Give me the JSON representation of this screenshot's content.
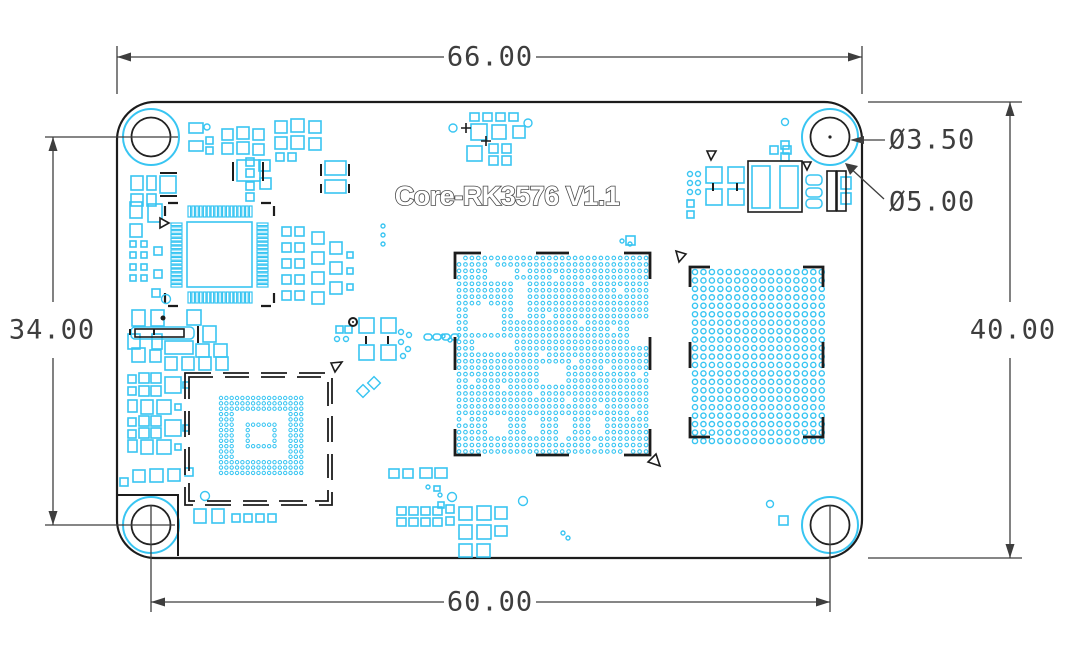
{
  "title": {
    "board_name": "Core-RK3576 V1.1"
  },
  "dimensions": {
    "board_width_label": "66.00",
    "hole_span_label": "60.00",
    "hole_vertical_span_label": "34.00",
    "board_height_label": "40.00",
    "hole_drill_label": "Ø3.50",
    "hole_pad_label": "Ø5.00"
  },
  "colors": {
    "copper": "#38c5f2",
    "outline": "#1c1c1c",
    "dim": "#3e3e3e",
    "title_stroke": "#4a4a4a"
  },
  "board": {
    "x": 117,
    "y": 102,
    "w": 745,
    "h": 456,
    "corner_radius": 38
  },
  "holes": {
    "centers": [
      [
        151,
        137
      ],
      [
        830,
        137
      ],
      [
        151,
        525
      ],
      [
        830,
        525
      ]
    ],
    "pad_r": 28,
    "drill_r": 19.5,
    "center_dot_index": 1
  },
  "footprints": {
    "qfp": {
      "body": [
        187,
        222,
        65,
        65
      ],
      "pins_per_side": 17,
      "pitch": 3.84,
      "pin_w": 2.6,
      "pin_len": 11,
      "pin_gap": 5
    },
    "bga_center": {
      "x0": 459,
      "y0": 258,
      "cols": 30,
      "rows": 31,
      "pitch": 6.45,
      "r": 1.8,
      "voids": [
        [
          5,
          2,
          4,
          2
        ],
        [
          2,
          8,
          5,
          4
        ],
        [
          3,
          13,
          6,
          2
        ],
        [
          9,
          4,
          2,
          6
        ],
        [
          5,
          25,
          3,
          3
        ],
        [
          11,
          25,
          2,
          3
        ],
        [
          16,
          25,
          2,
          3
        ],
        [
          21,
          25,
          2,
          3
        ],
        [
          27,
          10,
          3,
          4
        ],
        [
          13,
          17,
          4,
          3
        ]
      ]
    },
    "bga_right": {
      "x0": 695,
      "y0": 272,
      "cols": 16,
      "rows": 21,
      "pitch": 8.45,
      "r": 2.6
    },
    "bga_module": {
      "x0": 221,
      "y0": 398,
      "cols": 16,
      "rows": 15,
      "pitch": 5.35,
      "r": 1.7
    }
  },
  "pads": {
    "rects": [
      [
        189,
        123,
        14,
        10
      ],
      [
        189,
        141,
        14,
        10
      ],
      [
        206,
        137,
        7,
        7
      ],
      [
        206,
        147,
        7,
        7
      ],
      [
        222,
        129,
        11,
        11
      ],
      [
        237,
        127,
        12,
        12
      ],
      [
        253,
        129,
        11,
        11
      ],
      [
        222,
        143,
        11,
        11
      ],
      [
        237,
        142,
        12,
        12
      ],
      [
        253,
        144,
        11,
        11
      ],
      [
        275,
        121,
        12,
        12
      ],
      [
        291,
        119,
        13,
        13
      ],
      [
        309,
        121,
        12,
        12
      ],
      [
        275,
        137,
        12,
        12
      ],
      [
        291,
        136,
        13,
        13
      ],
      [
        309,
        138,
        12,
        12
      ],
      [
        246,
        158,
        8,
        8
      ],
      [
        246,
        169,
        8,
        8
      ],
      [
        259,
        160,
        11,
        11
      ],
      [
        276,
        153,
        8,
        8
      ],
      [
        288,
        153,
        8,
        8
      ],
      [
        237,
        160,
        23,
        21
      ],
      [
        325,
        161,
        21,
        14
      ],
      [
        325,
        180,
        21,
        13
      ],
      [
        246,
        182,
        8,
        8
      ],
      [
        246,
        193,
        8,
        8
      ],
      [
        260,
        178,
        11,
        11
      ],
      [
        131,
        176,
        12,
        14
      ],
      [
        147,
        176,
        9,
        14
      ],
      [
        160,
        176,
        16,
        17
      ],
      [
        131,
        194,
        12,
        12
      ],
      [
        147,
        194,
        9,
        12
      ],
      [
        130,
        202,
        12,
        16
      ],
      [
        148,
        204,
        14,
        18
      ],
      [
        130,
        224,
        12,
        13
      ],
      [
        130,
        241,
        6,
        6
      ],
      [
        141,
        241,
        6,
        6
      ],
      [
        130,
        252,
        6,
        6
      ],
      [
        141,
        252,
        6,
        6
      ],
      [
        154,
        247,
        8,
        8
      ],
      [
        130,
        264,
        6,
        6
      ],
      [
        141,
        264,
        6,
        6
      ],
      [
        130,
        275,
        6,
        6
      ],
      [
        141,
        275,
        6,
        6
      ],
      [
        154,
        270,
        8,
        8
      ],
      [
        152,
        289,
        8,
        8
      ],
      [
        132,
        310,
        13,
        16
      ],
      [
        151,
        310,
        13,
        16
      ],
      [
        187,
        310,
        14,
        15
      ],
      [
        203,
        326,
        13,
        16
      ],
      [
        132,
        348,
        13,
        14
      ],
      [
        150,
        350,
        11,
        12
      ],
      [
        196,
        344,
        13,
        13
      ],
      [
        214,
        344,
        13,
        13
      ],
      [
        165,
        341,
        28,
        13
      ],
      [
        128,
        334,
        12,
        15
      ],
      [
        152,
        334,
        10,
        15
      ],
      [
        165,
        357,
        12,
        13
      ],
      [
        182,
        357,
        12,
        13
      ],
      [
        199,
        357,
        12,
        13
      ],
      [
        216,
        357,
        12,
        13
      ],
      [
        128,
        375,
        8,
        8
      ],
      [
        139,
        373,
        10,
        10
      ],
      [
        151,
        373,
        10,
        10
      ],
      [
        128,
        387,
        8,
        8
      ],
      [
        139,
        386,
        10,
        10
      ],
      [
        151,
        386,
        10,
        10
      ],
      [
        165,
        377,
        16,
        16
      ],
      [
        183,
        382,
        6,
        6
      ],
      [
        128,
        400,
        9,
        12
      ],
      [
        141,
        400,
        12,
        14
      ],
      [
        157,
        400,
        14,
        14
      ],
      [
        175,
        404,
        6,
        6
      ],
      [
        128,
        418,
        8,
        8
      ],
      [
        139,
        416,
        10,
        10
      ],
      [
        151,
        416,
        10,
        10
      ],
      [
        128,
        430,
        8,
        8
      ],
      [
        139,
        428,
        10,
        10
      ],
      [
        151,
        428,
        10,
        10
      ],
      [
        165,
        420,
        16,
        16
      ],
      [
        183,
        425,
        6,
        6
      ],
      [
        128,
        440,
        9,
        12
      ],
      [
        141,
        440,
        12,
        14
      ],
      [
        157,
        440,
        14,
        14
      ],
      [
        175,
        444,
        6,
        6
      ],
      [
        120,
        478,
        8,
        8
      ],
      [
        133,
        470,
        12,
        12
      ],
      [
        150,
        469,
        13,
        13
      ],
      [
        168,
        469,
        12,
        12
      ],
      [
        185,
        468,
        8,
        8
      ],
      [
        194,
        509,
        12,
        14
      ],
      [
        212,
        509,
        12,
        14
      ],
      [
        232,
        514,
        8,
        8
      ],
      [
        244,
        514,
        8,
        8
      ],
      [
        256,
        514,
        8,
        8
      ],
      [
        268,
        514,
        8,
        8
      ],
      [
        282,
        227,
        9,
        9
      ],
      [
        295,
        227,
        9,
        9
      ],
      [
        282,
        243,
        9,
        9
      ],
      [
        295,
        243,
        9,
        9
      ],
      [
        282,
        259,
        9,
        9
      ],
      [
        295,
        259,
        9,
        9
      ],
      [
        282,
        275,
        9,
        9
      ],
      [
        295,
        275,
        9,
        9
      ],
      [
        282,
        291,
        9,
        9
      ],
      [
        295,
        291,
        9,
        9
      ],
      [
        312,
        232,
        12,
        12
      ],
      [
        312,
        252,
        12,
        12
      ],
      [
        312,
        272,
        12,
        12
      ],
      [
        312,
        292,
        12,
        12
      ],
      [
        330,
        242,
        12,
        12
      ],
      [
        330,
        262,
        12,
        12
      ],
      [
        330,
        282,
        12,
        12
      ],
      [
        347,
        252,
        6,
        6
      ],
      [
        347,
        268,
        6,
        6
      ],
      [
        347,
        284,
        6,
        6
      ],
      [
        359,
        318,
        15,
        15
      ],
      [
        381,
        318,
        15,
        15
      ],
      [
        359,
        345,
        15,
        15
      ],
      [
        381,
        345,
        15,
        15
      ],
      [
        336,
        326,
        7,
        7
      ],
      [
        345,
        326,
        7,
        7
      ],
      [
        470,
        113,
        9,
        8
      ],
      [
        483,
        113,
        9,
        8
      ],
      [
        496,
        113,
        9,
        8
      ],
      [
        509,
        113,
        9,
        8
      ],
      [
        471,
        124,
        16,
        16
      ],
      [
        492,
        125,
        14,
        14
      ],
      [
        513,
        126,
        12,
        12
      ],
      [
        467,
        146,
        15,
        15
      ],
      [
        489,
        144,
        9,
        9
      ],
      [
        502,
        144,
        9,
        9
      ],
      [
        489,
        156,
        9,
        9
      ],
      [
        502,
        156,
        9,
        9
      ],
      [
        626,
        236,
        9,
        9
      ],
      [
        687,
        200,
        7,
        7
      ],
      [
        687,
        211,
        7,
        7
      ],
      [
        706,
        167,
        16,
        16
      ],
      [
        728,
        167,
        16,
        16
      ],
      [
        706,
        189,
        16,
        16
      ],
      [
        728,
        189,
        16,
        16
      ],
      [
        770,
        146,
        8,
        8
      ],
      [
        783,
        146,
        8,
        8
      ],
      [
        781,
        141,
        8,
        8
      ],
      [
        781,
        153,
        8,
        8
      ],
      [
        841,
        177,
        10,
        12
      ],
      [
        841,
        193,
        10,
        11
      ],
      [
        389,
        469,
        10,
        9
      ],
      [
        403,
        469,
        10,
        9
      ],
      [
        420,
        468,
        12,
        10
      ],
      [
        435,
        468,
        12,
        10
      ],
      [
        434,
        486,
        6,
        5
      ],
      [
        438,
        502,
        6,
        6
      ],
      [
        397,
        507,
        9,
        8
      ],
      [
        409,
        507,
        9,
        8
      ],
      [
        421,
        507,
        9,
        8
      ],
      [
        433,
        507,
        9,
        8
      ],
      [
        397,
        518,
        9,
        8
      ],
      [
        409,
        518,
        9,
        8
      ],
      [
        421,
        518,
        9,
        8
      ],
      [
        433,
        518,
        9,
        8
      ],
      [
        446,
        505,
        8,
        8
      ],
      [
        446,
        517,
        8,
        8
      ],
      [
        459,
        507,
        13,
        13
      ],
      [
        477,
        506,
        14,
        14
      ],
      [
        495,
        507,
        12,
        12
      ],
      [
        459,
        525,
        13,
        14
      ],
      [
        477,
        525,
        14,
        14
      ],
      [
        495,
        526,
        12,
        10
      ],
      [
        459,
        544,
        13,
        13
      ],
      [
        477,
        544,
        13,
        13
      ],
      [
        779,
        516,
        9,
        9
      ]
    ],
    "ovals": [
      [
        424,
        334,
        8,
        6
      ],
      [
        433,
        334,
        8,
        6
      ],
      [
        442,
        334,
        8,
        6
      ],
      [
        451,
        334,
        8,
        6
      ],
      [
        806,
        175,
        16,
        10
      ],
      [
        806,
        188,
        16,
        9
      ],
      [
        806,
        199,
        16,
        9
      ],
      [
        131,
        327,
        63,
        12
      ]
    ],
    "bars": [
      [
        752,
        166,
        18,
        42
      ],
      [
        780,
        166,
        18,
        42
      ]
    ],
    "circles": [
      [
        207,
        127,
        3
      ],
      [
        166,
        299,
        4.5
      ],
      [
        205,
        496,
        4.5
      ],
      [
        383,
        226,
        2
      ],
      [
        383,
        235,
        2
      ],
      [
        383,
        244,
        2
      ],
      [
        337,
        339,
        2.5
      ],
      [
        346,
        339,
        2.5
      ],
      [
        401,
        332,
        2.5
      ],
      [
        409,
        335,
        2.5
      ],
      [
        401,
        342,
        2.5
      ],
      [
        408,
        349,
        2.5
      ],
      [
        403,
        356,
        2.5
      ],
      [
        443,
        336,
        2
      ],
      [
        450,
        340,
        2
      ],
      [
        453,
        128,
        4
      ],
      [
        528,
        123,
        4
      ],
      [
        622,
        241,
        2
      ],
      [
        630,
        244,
        2
      ],
      [
        690,
        174,
        2.5
      ],
      [
        698,
        174,
        2.5
      ],
      [
        690,
        183,
        2.5
      ],
      [
        698,
        183,
        2.5
      ],
      [
        690,
        192,
        2.5
      ],
      [
        698,
        192,
        2.5
      ],
      [
        785,
        122,
        3.5
      ],
      [
        428,
        487,
        2
      ],
      [
        440,
        495,
        2
      ],
      [
        452,
        497,
        4.5
      ],
      [
        523,
        501,
        4.5
      ],
      [
        563,
        533,
        2
      ],
      [
        568,
        538,
        2
      ],
      [
        770,
        504,
        3.5
      ]
    ],
    "diamonds": [
      [
        363,
        391,
        9
      ],
      [
        374,
        383,
        9
      ]
    ]
  },
  "marks": {
    "black_ticks": [
      [
        233,
        162,
        233,
        181
      ],
      [
        263,
        162,
        263,
        181
      ],
      [
        321,
        164,
        321,
        176
      ],
      [
        349,
        164,
        349,
        176
      ],
      [
        321,
        184,
        321,
        193
      ],
      [
        349,
        184,
        349,
        193
      ],
      [
        198,
        326,
        198,
        343
      ],
      [
        366,
        336,
        366,
        344
      ],
      [
        388,
        336,
        388,
        344
      ],
      [
        130,
        329,
        130,
        335
      ],
      [
        154,
        329,
        154,
        335
      ],
      [
        713,
        183,
        713,
        191
      ],
      [
        737,
        183,
        737,
        191
      ],
      [
        160,
        173,
        177,
        173
      ],
      [
        160,
        196,
        177,
        196
      ]
    ],
    "black_rects": [
      [
        748,
        161,
        54,
        51
      ],
      [
        135,
        329,
        49,
        8
      ],
      [
        827,
        171,
        9,
        40
      ],
      [
        837,
        171,
        9,
        40
      ]
    ],
    "l_path": "M118,495 H178 V556",
    "crosses": [
      [
        466,
        128
      ],
      [
        486,
        141
      ]
    ],
    "black_dots": [
      [
        163,
        318,
        2.5
      ]
    ],
    "black_donuts": [
      [
        353,
        322,
        4
      ]
    ],
    "triangles": [
      [
        [
          160,
          218
        ],
        [
          160,
          228
        ],
        [
          169,
          223
        ]
      ],
      [
        [
          707,
          151
        ],
        [
          716,
          151
        ],
        [
          711,
          160
        ]
      ],
      [
        [
          803,
          162
        ],
        [
          811,
          162
        ],
        [
          807,
          170
        ]
      ],
      [
        [
          331,
          363
        ],
        [
          342,
          362
        ],
        [
          335,
          372
        ]
      ],
      [
        [
          676,
          251
        ],
        [
          686,
          254
        ],
        [
          679,
          262
        ]
      ],
      [
        [
          648,
          462
        ],
        [
          660,
          466
        ],
        [
          656,
          454
        ]
      ]
    ]
  }
}
